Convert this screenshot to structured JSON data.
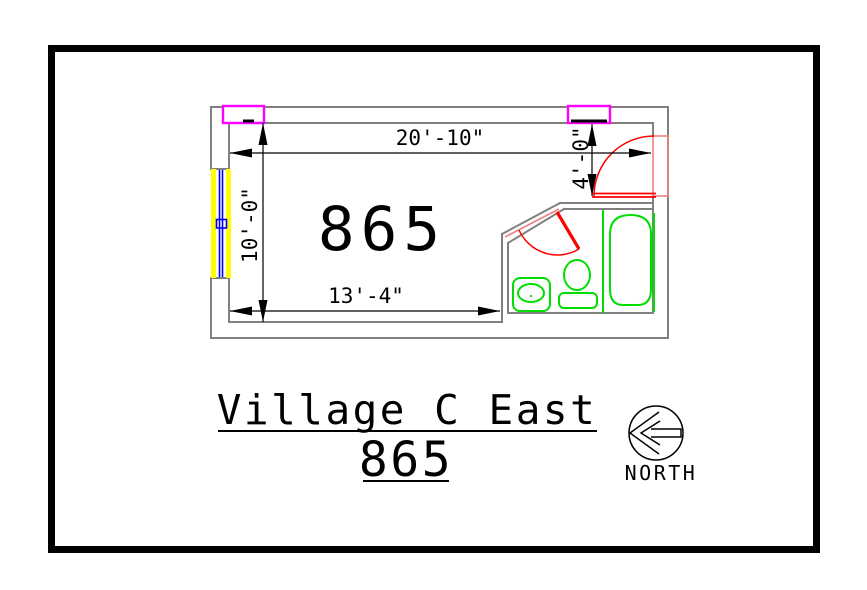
{
  "drawing": {
    "title": "Village C East",
    "subtitle": "865",
    "room_number": "865",
    "north_label": "NORTH",
    "dimensions": {
      "room_width": "20'-10\"",
      "room_depth": "10'-0\"",
      "bottom_width": "13'-4\"",
      "entry_width": "4'-0\""
    },
    "icons": {
      "north_arrow": "circle-arrow-left"
    },
    "colors": {
      "sheet_border": "#000000",
      "wall": "#808080",
      "dimension": "#000000",
      "door": "#ff0000",
      "door_frame": "#f08080",
      "fixture_green": "#00dd00",
      "window_frame": "#ffff00",
      "window_glazing": "#0000ff",
      "window_unit": "#ff00ff",
      "background": "#ffffff"
    }
  }
}
